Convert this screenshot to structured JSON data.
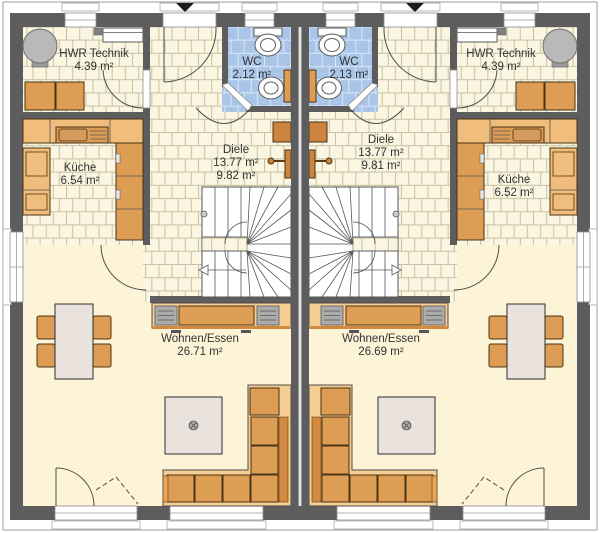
{
  "plan": {
    "type": "floor-plan",
    "units": [
      {
        "name": "left-unit",
        "rooms": [
          {
            "key": "hwr",
            "name": "HWR Technik",
            "area": "4.39 m²"
          },
          {
            "key": "wc",
            "name": "WC",
            "area": "2.12 m²"
          },
          {
            "key": "diele",
            "name": "Diele",
            "area": "13.77 m²",
            "area_secondary": "9.82 m²"
          },
          {
            "key": "kueche",
            "name": "Küche",
            "area": "6.54 m²"
          },
          {
            "key": "wohnen",
            "name": "Wohnen/Essen",
            "area": "26.71 m²"
          }
        ]
      },
      {
        "name": "right-unit",
        "rooms": [
          {
            "key": "hwr",
            "name": "HWR Technik",
            "area": "4.39 m²"
          },
          {
            "key": "wc",
            "name": "WC",
            "area": "2.13 m²"
          },
          {
            "key": "diele",
            "name": "Diele",
            "area": "13.77 m²",
            "area_secondary": "9.81 m²"
          },
          {
            "key": "kueche",
            "name": "Küche",
            "area": "6.52 m²"
          },
          {
            "key": "wohnen",
            "name": "Wohnen/Essen",
            "area": "26.69 m²"
          }
        ]
      }
    ],
    "icons": {
      "entrance_marker": "triangle-down",
      "stair_direction": "arrow",
      "ceiling_lamp": "circle-cross"
    }
  },
  "colors": {
    "wall": "#5d5d5d",
    "floor_living": "#fdf3d6",
    "tile_bg": "#faf6e1",
    "tile_line": "#c6c1a4",
    "wc_tile_bg": "#a9c5e7",
    "wc_tile_line": "#dde8f7",
    "furn_light": "#f0bd7c",
    "furn_mid": "#de9d55",
    "furn_dark": "#cb853f",
    "platform": "#f6cd92",
    "table_top": "#eae2dd"
  }
}
